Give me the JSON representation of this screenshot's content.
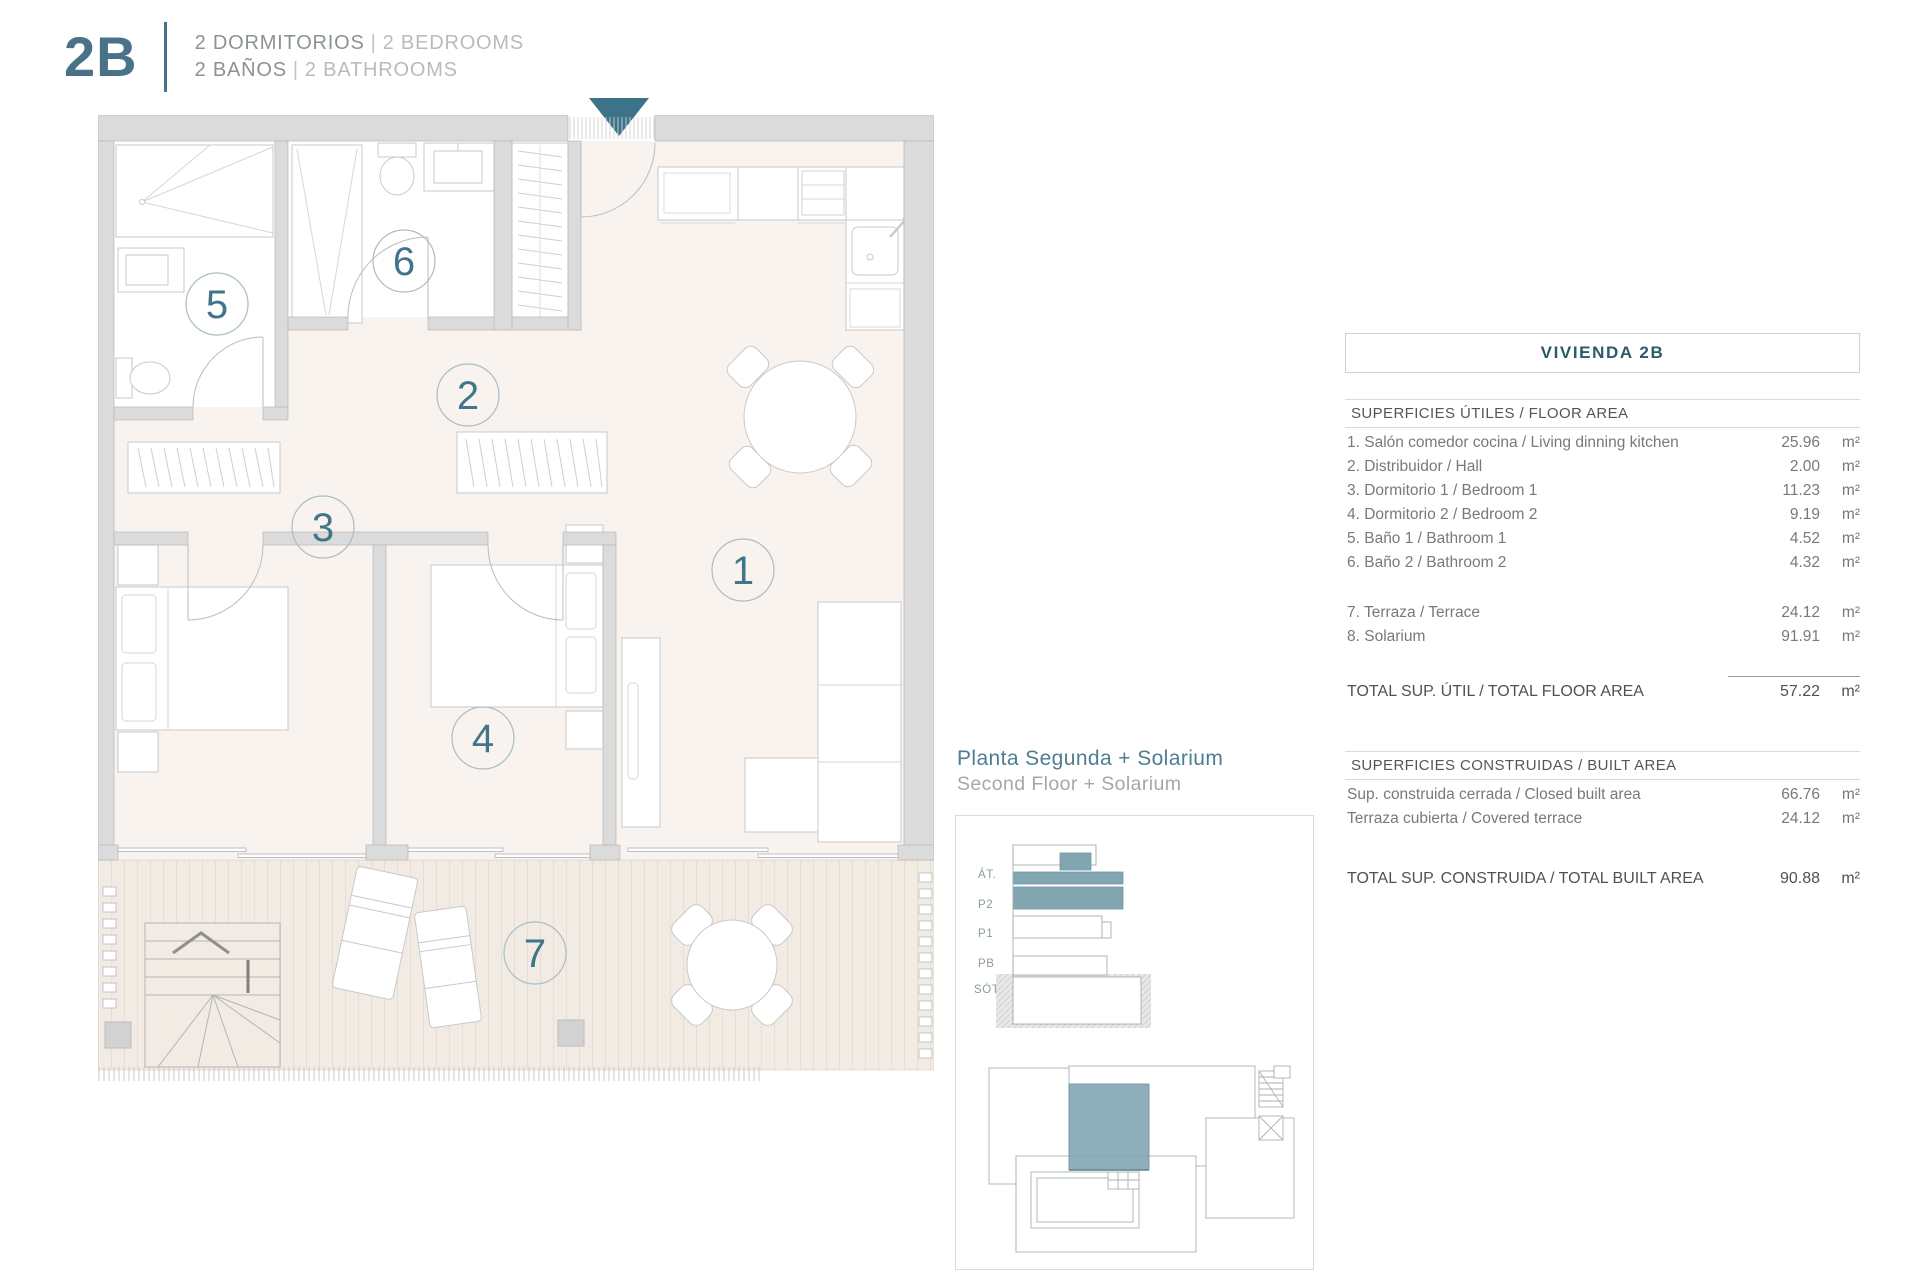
{
  "header": {
    "unit_code": "2B",
    "separator": "|",
    "line1_primary": "2 DORMITORIOS",
    "line1_secondary": "2 BEDROOMS",
    "line2_primary": "2 BAÑOS",
    "line2_secondary": "2 BATHROOMS"
  },
  "plan": {
    "room_labels": [
      "1",
      "2",
      "3",
      "4",
      "5",
      "6",
      "7"
    ]
  },
  "inset": {
    "caption_primary": "Planta Segunda + Solarium",
    "caption_secondary": "Second Floor + Solarium",
    "elevation_labels": [
      "ÁT.",
      "P2",
      "P1",
      "PB",
      "SÓT."
    ]
  },
  "table": {
    "title": "VIVIENDA 2B",
    "unit": "m²",
    "floor_area": {
      "section": "SUPERFICIES ÚTILES / FLOOR AREA",
      "rows": [
        {
          "label": "1. Salón comedor cocina / Living dinning kitchen",
          "value": "25.96"
        },
        {
          "label": "2. Distribuidor / Hall",
          "value": "2.00"
        },
        {
          "label": "3. Dormitorio 1 / Bedroom 1",
          "value": "11.23"
        },
        {
          "label": "4. Dormitorio 2 / Bedroom 2",
          "value": "9.19"
        },
        {
          "label": "5. Baño 1 / Bathroom 1",
          "value": "4.52"
        },
        {
          "label": "6. Baño 2 / Bathroom 2",
          "value": "4.32"
        }
      ],
      "rows_outdoor": [
        {
          "label": "7. Terraza / Terrace",
          "value": "24.12"
        },
        {
          "label": "8. Solarium",
          "value": "91.91"
        }
      ],
      "total_label": "TOTAL SUP. ÚTIL / TOTAL FLOOR AREA",
      "total_value": "57.22"
    },
    "built_area": {
      "section": "SUPERFICIES CONSTRUIDAS / BUILT AREA",
      "rows": [
        {
          "label": "Sup. construida cerrada / Closed built area",
          "value": "66.76"
        },
        {
          "label": "Terraza cubierta / Covered terrace",
          "value": "24.12"
        }
      ],
      "total_label": "TOTAL SUP. CONSTRUIDA /  TOTAL BUILT AREA",
      "total_value": "90.88"
    }
  },
  "colors": {
    "accent_teal": "#41758a",
    "slate_highlight": "#82a5b2",
    "wall_gray": "#dbdbdb",
    "room_floor": "#f8f3ee",
    "terrace_floor": "#f1ebe4",
    "table_title": "#2a5a6c"
  }
}
